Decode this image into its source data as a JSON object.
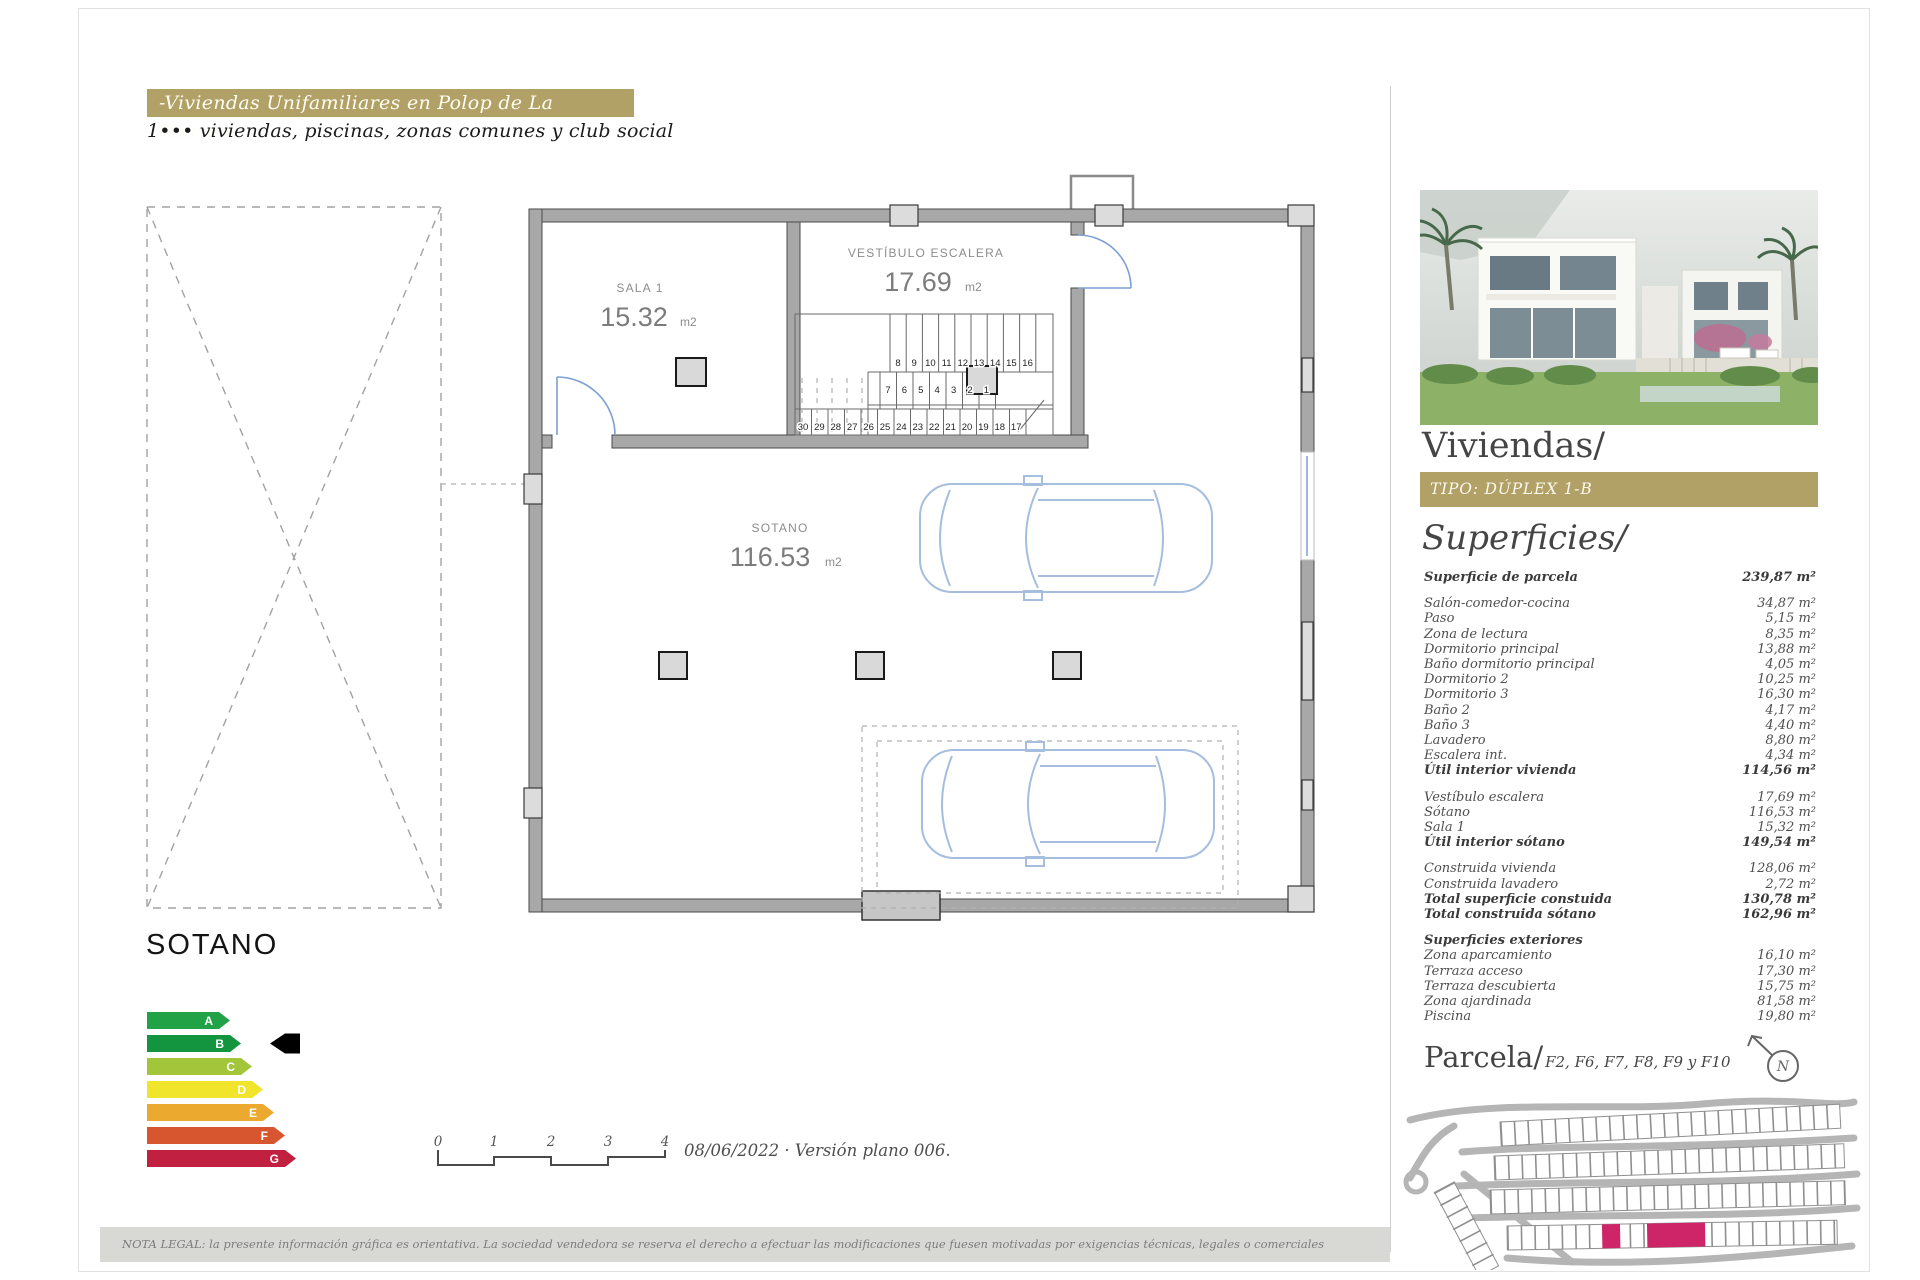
{
  "header": {
    "banner": "-Viviendas Unifamiliares en Polop de La Marina-",
    "subtitle": "1••• viviendas, piscinas, zonas comunes y club social"
  },
  "plan": {
    "floor_label": "SOTANO",
    "rooms": {
      "sala": {
        "name": "SALA 1",
        "area": "15.32",
        "unit": "m2"
      },
      "vestibulo": {
        "name": "VESTÍBULO ESCALERA",
        "area": "17.69",
        "unit": "m2"
      },
      "sotano": {
        "name": "SOTANO",
        "area": "116.53",
        "unit": "m2"
      }
    },
    "stairs": {
      "top": [
        "8",
        "9",
        "10",
        "11",
        "12",
        "13",
        "14",
        "15",
        "16"
      ],
      "middle": [
        "7",
        "6",
        "5",
        "4",
        "3",
        "2",
        "1"
      ],
      "bottom": [
        "30",
        "29",
        "28",
        "27",
        "26",
        "25",
        "24",
        "23",
        "22",
        "21",
        "20",
        "19",
        "18",
        "17"
      ]
    }
  },
  "energy_label": {
    "grades": [
      {
        "letter": "A",
        "color": "#22a246"
      },
      {
        "letter": "B",
        "color": "#13953f"
      },
      {
        "letter": "C",
        "color": "#a3c53a"
      },
      {
        "letter": "D",
        "color": "#f1e52b"
      },
      {
        "letter": "E",
        "color": "#eca92f"
      },
      {
        "letter": "F",
        "color": "#d8562f"
      },
      {
        "letter": "G",
        "color": "#c22040"
      }
    ],
    "selected": "B",
    "pointer_color": "#000000"
  },
  "scale_bar": {
    "ticks": [
      "0",
      "1",
      "2",
      "3",
      "4"
    ],
    "caption": "08/06/2022 · Versión plano 006."
  },
  "sidebar": {
    "title": "Viviendas/",
    "type_banner": "TIPO: DÚPLEX 1-B",
    "accent_color": "#b2a166",
    "surfaces_title": "Superficies/",
    "surfaces": [
      {
        "label": "Superficie de parcela",
        "value": "239,87 m²",
        "bold": true
      },
      {
        "label": "Salón-comedor-cocina",
        "value": "34,87 m²",
        "gap": true
      },
      {
        "label": "Paso",
        "value": "5,15 m²"
      },
      {
        "label": "Zona de lectura",
        "value": "8,35 m²"
      },
      {
        "label": "Dormitorio principal",
        "value": "13,88 m²"
      },
      {
        "label": "Baño dormitorio principal",
        "value": "4,05 m²"
      },
      {
        "label": "Dormitorio 2",
        "value": "10,25 m²"
      },
      {
        "label": "Dormitorio 3",
        "value": "16,30 m²"
      },
      {
        "label": "Baño 2",
        "value": "4,17 m²"
      },
      {
        "label": "Baño 3",
        "value": "4,40 m²"
      },
      {
        "label": "Lavadero",
        "value": "8,80 m²"
      },
      {
        "label": "Escalera int.",
        "value": "4,34 m²"
      },
      {
        "label": "Útil interior vivienda",
        "value": "114,56 m²",
        "bold": true
      },
      {
        "label": "Vestíbulo escalera",
        "value": "17,69 m²",
        "gap": true
      },
      {
        "label": "Sótano",
        "value": "116,53 m²"
      },
      {
        "label": "Sala 1",
        "value": "15,32 m²"
      },
      {
        "label": "Útil interior sótano",
        "value": "149,54 m²",
        "bold": true
      },
      {
        "label": "Construida vivienda",
        "value": "128,06 m²",
        "gap": true
      },
      {
        "label": "Construida lavadero",
        "value": "2,72 m²"
      },
      {
        "label": "Total superficie constuida",
        "value": "130,78 m²",
        "bold": true
      },
      {
        "label": "Total construida sótano",
        "value": "162,96 m²",
        "bold": true
      },
      {
        "label": "Superficies exteriores",
        "value": "",
        "bold": true,
        "gap": true
      },
      {
        "label": "Zona aparcamiento",
        "value": "16,10 m²"
      },
      {
        "label": "Terraza acceso",
        "value": "17,30 m²"
      },
      {
        "label": "Terraza descubierta",
        "value": "15,75 m²"
      },
      {
        "label": "Zona ajardinada",
        "value": "81,58 m²"
      },
      {
        "label": "Piscina",
        "value": "19,80 m²"
      }
    ],
    "parcela_title": "Parcela/",
    "parcela_subtitle": "F2, F6, F7, F8, F9 y F10",
    "compass_letter": "N",
    "map_highlight_color": "#ce2468"
  },
  "footer": {
    "legal": "NOTA LEGAL: la presente información gráfica es orientativa. La sociedad vendedora se reserva el derecho a efectuar las modificaciones que fuesen motivadas por exigencias técnicas, legales o comerciales"
  }
}
